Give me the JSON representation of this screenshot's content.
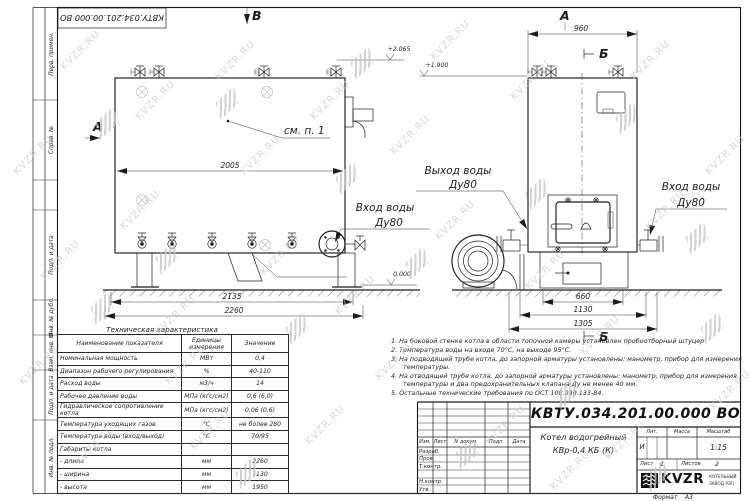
{
  "designation": "КВТУ.034.201.00.000 ВО",
  "frame": {
    "left_labels": [
      "Перв. примен.",
      "Справ. №",
      "Подп. и дата",
      "Инв. № дубл.",
      "Взам. инв. №",
      "Подп. и дата",
      "Инв. № подл."
    ]
  },
  "views": {
    "markers": {
      "left_a": "А",
      "top_b": "В",
      "right_a": "А",
      "section_b_top": "Б",
      "section_b_bottom": "Б"
    },
    "callout": "см. п. 1",
    "labels": {
      "outlet1": "Выход воды",
      "outlet2": "Ду80",
      "inlet_mid1": "Вход воды",
      "inlet_mid2": "Ду80",
      "inlet_right1": "Вход воды",
      "inlet_right2": "Ду80"
    },
    "elevations": {
      "e1": "+2.065",
      "e2": "+1.900",
      "e0": "0.000"
    },
    "dims": {
      "d2005": "2005",
      "d2135": "2135",
      "d2260": "2260",
      "d960": "960",
      "d660": "660",
      "d1130": "1130",
      "d1305": "1305"
    }
  },
  "spec_table": {
    "title": "Техническая характеристика",
    "headers": [
      "Наименование показателя",
      "Единицы измерения",
      "Значение"
    ],
    "rows": [
      [
        "Номинальная мощность",
        "МВт",
        "0,4"
      ],
      [
        "Диапазон рабочего регулирования",
        "%",
        "40-110"
      ],
      [
        "Расход воды",
        "м3/ч",
        "14"
      ],
      [
        "Рабочее давление воды",
        "МПа (кгс/см2)",
        "0,6 (6,0)"
      ],
      [
        "Гидравлическое сопротивление котла",
        "МПа (кгс/см2)",
        "0,06 (0,6)"
      ],
      [
        "Температура уходящих газов",
        "°С",
        "не более 280"
      ],
      [
        "Температура воды (вход/выход)",
        "°С",
        "70/95"
      ],
      [
        "Габариты котла",
        "",
        ""
      ],
      [
        "- длина",
        "мм",
        "2260"
      ],
      [
        "- ширина",
        "мм",
        "1130"
      ],
      [
        "- высота",
        "мм",
        "1950"
      ]
    ]
  },
  "notes": [
    "1.  На боковой стенке котла в области топочной камеры установлен пробоотборный штуцер",
    "2.  Температура воды на входе 70°С, на выходе 95°С.",
    "3.  На подводящей трубе котла, до запорной арматуры установлены: манометр, прибор для измерения температуры.",
    "4.  На отводящей трубе котла, до запорной арматуры установлены: манометр, прибор для измерения температуры и два предохранительных клапана Ду не менее 40 мм.",
    "5.  Остальные технические требования по ОСТ 108.030.133-84."
  ],
  "title_block": {
    "product_line1": "Котел водогрейный",
    "product_line2": "КВр-0,4  КБ  (К)",
    "rev_headers": [
      "Изм.",
      "Лист",
      "N докум.",
      "Подп.",
      "Дата"
    ],
    "sign_rows": [
      "Разраб.",
      "Пров.",
      "Т.контр.",
      "Н.контр.",
      "Утв."
    ],
    "lit_label": "Лит.",
    "mass_label": "Масса",
    "scale_label": "Масштаб",
    "lit_value": "И",
    "scale_value": "1:15",
    "sheet_label": "Лист",
    "sheet_value": "1",
    "sheets_label": "Листов",
    "sheets_value": "2",
    "company": "KVZR",
    "company_line1": "КОТЕЛЬНЫЙ",
    "company_line2": "ЗАВОД РЭП",
    "format_label": "Формат",
    "format_value": "А3"
  },
  "watermark": {
    "text": "KVZR.RU"
  }
}
